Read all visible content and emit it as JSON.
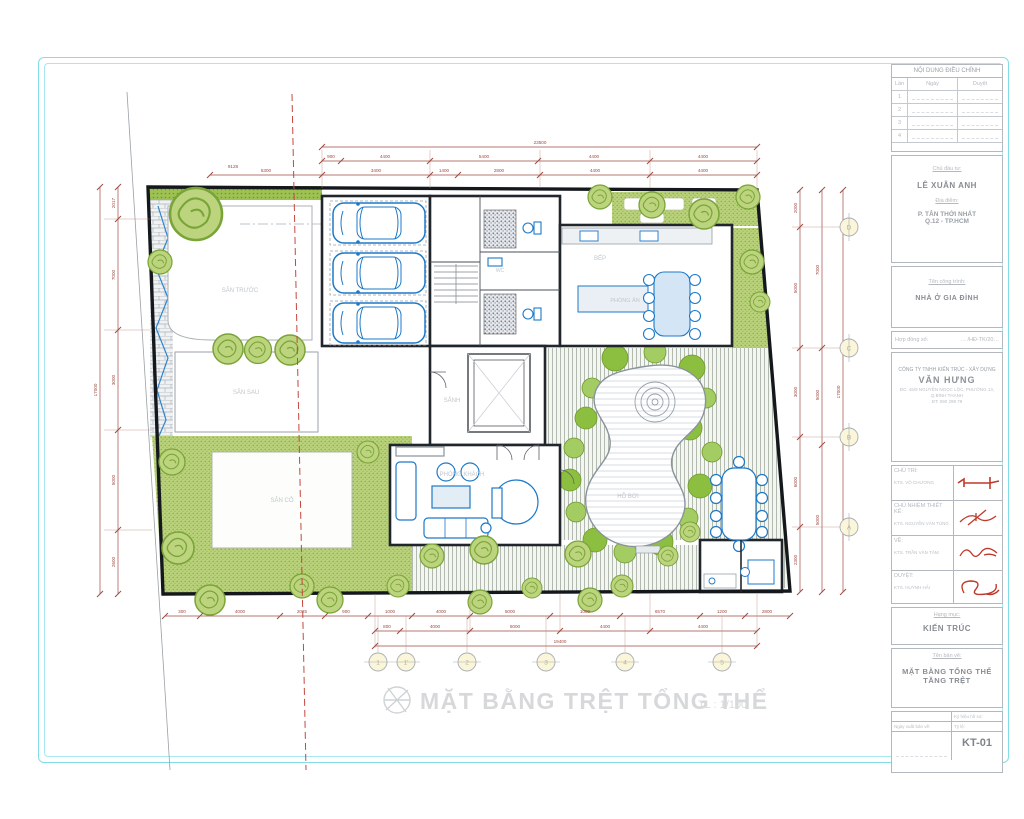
{
  "colors": {
    "frame_cyan": "#82dde8",
    "plant_green": "#9dc253",
    "furniture_blue": "#1d79c8",
    "dimension_red": "#9e4a42",
    "boundary_red": "#c4473f"
  },
  "plan": {
    "title": "MẶT BẰNG TRỆT TỔNG THỂ",
    "scale_note": "TL : 1/100",
    "room_labels": {
      "front_yard": "SÂN TRƯỚC",
      "terrace": "SÂN SAU",
      "lawn": "SÂN CỎ",
      "hall": "SẢNH",
      "wc": "WC",
      "kitchen": "BẾP",
      "dining": "PHÒNG ĂN",
      "living": "PHÒNG KHÁCH",
      "pool": "HỒ BƠI"
    },
    "dims": {
      "top_total": "23500",
      "top_row2": [
        "900",
        "4400",
        "5400",
        "4400",
        "4400"
      ],
      "top_row3": [
        "5300",
        "3400",
        "1400",
        "2800",
        "4400",
        "4400"
      ],
      "corner": "9128",
      "left_total": "17000",
      "left": [
        "2017",
        "7000",
        "3000",
        "5000",
        "2600"
      ],
      "right_total": "17000",
      "right": [
        "2000",
        "5000",
        "3000",
        "6000",
        "2300"
      ],
      "right_mid": [
        "7000",
        "5000",
        "5000"
      ],
      "bottom_row1": [
        "300",
        "4000",
        "2025",
        "900",
        "1000",
        "4000",
        "5000",
        "1000",
        "6570",
        "1200",
        "2800"
      ],
      "bottom_row2": [
        "800",
        "4000",
        "5000",
        "4400",
        "4400"
      ],
      "bottom_total": "19400"
    },
    "grid_bottom": [
      "1",
      "1'",
      "2",
      "3",
      "4",
      "5"
    ],
    "grid_right": [
      "D",
      "C",
      "B",
      "A"
    ]
  },
  "titleblock": {
    "revision_header": "NỘI DUNG ĐIỀU CHỈNH",
    "revision_cols": [
      "Lần",
      "Ngày",
      "Duyệt"
    ],
    "revision_rows": [
      "1",
      "2",
      "3",
      "4"
    ],
    "client_label": "Chủ đầu tư:",
    "client_name": "LÊ XUÂN ANH",
    "site_label": "Địa điểm:",
    "site_line1": "P. TÂN THỚI NHẤT",
    "site_line2": "Q.12 - TP.HCM",
    "project_label": "Tên công trình:",
    "project_name": "NHÀ Ở GIA ĐÌNH",
    "contract_label": "Hợp đồng số:",
    "contract_value": "… /HĐ-TK/20…",
    "firm_line1": "CÔNG TY TNHH KIẾN TRÚC - XÂY DỰNG",
    "firm_name": "VĂN HƯNG",
    "firm_addr1": "ĐC: 46/9 NGUYỄN NGỌC LỘC, PHƯỜNG 14,",
    "firm_addr2": "Q.BÌNH THẠNH",
    "firm_tel": "ĐT: 090 299 79",
    "sign_rows": [
      {
        "label": "CHỦ TRÌ:",
        "name": "KTS. VÕ CHƯƠNG"
      },
      {
        "label": "CHỦ NHIỆM THIẾT KẾ:",
        "name": "KTS. NGUYỄN VĂN TÙNG"
      },
      {
        "label": "VẼ:",
        "name": "KTS. TRẦN VĂN TÂM"
      },
      {
        "label": "DUYỆT:",
        "name": "KTS. HUỲNH HẢI"
      }
    ],
    "category_label": "Hạng mục:",
    "category_value": "KIẾN TRÚC",
    "sheet_label": "Tên bản vẽ:",
    "sheet_name1": "MẶT BẰNG TỔNG THỂ",
    "sheet_name2": "TẦNG TRỆT",
    "issue_label": "Ngày xuất bản vẽ:",
    "code_label": "Ký hiệu hồ sơ:",
    "scale_label": "Tỷ lệ:",
    "sheet_code": "KT-01"
  }
}
